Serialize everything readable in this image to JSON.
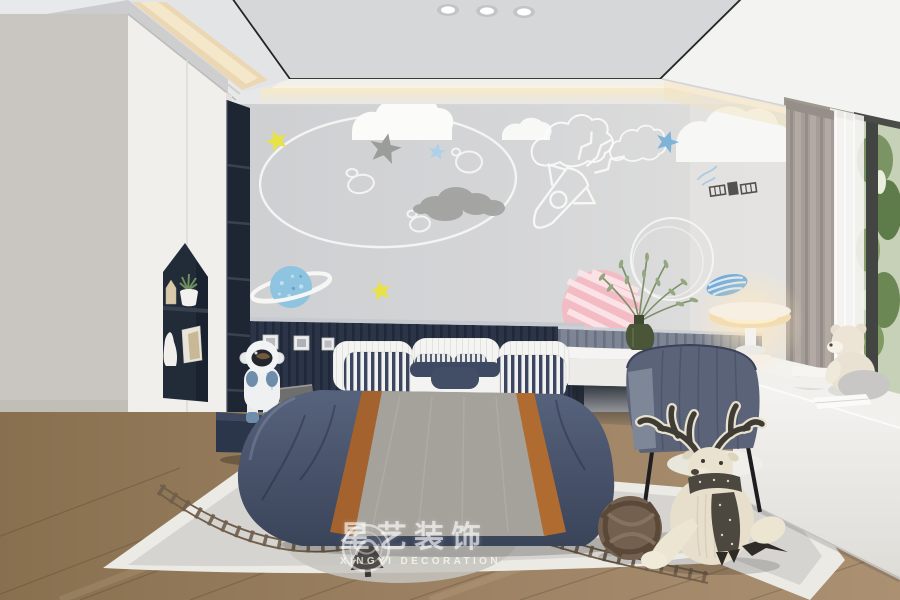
{
  "meta": {
    "type": "interior-design-3d-render",
    "room": "children-bedroom-space-theme",
    "canvas": {
      "width": 900,
      "height": 600
    }
  },
  "watermark": {
    "logo": "xingyi-circle-seal",
    "cn": "星艺装饰",
    "en": "XINGYI DECORATION"
  },
  "palette": {
    "wall": "#d2d3d5",
    "ceiling_panel": "#d5d7d9",
    "trim_black": "#242424",
    "cove_glow": "#f2e2bd",
    "wardrobe_white": "#f0efec",
    "accent_navy": "#2c3547",
    "shelf_navy": "#1e2634",
    "duvet_navy": "#46526b",
    "duvet_gray": "#a5a29b",
    "stripe_caramel": "#a8652c",
    "bed_base_gray": "#8f8d88",
    "wood_floor": "#9a8064",
    "rug_field": "#d6d4d0",
    "rug_border": "#eceae5",
    "track_brown": "#6f5e4b",
    "curtain_gray": "#a59d97",
    "sheer_white": "#f6f5f2",
    "window_green": "#7a9463",
    "seat_white": "#f1f0ed",
    "chair_navy": "#5a6377",
    "lamp_warm": "#f3ddb0",
    "deer_cream": "#e7dfcb",
    "deer_dark": "#4c4840",
    "knot_brown": "#74604f",
    "astronaut_white": "#eef0f1",
    "astronaut_blue": "#6d8dab",
    "star_yellow": "#e9e244",
    "star_blue": "#7fb3d8",
    "star_gray": "#9c9c9a",
    "planet_blue": "#8ec4e0",
    "planet_pink": "#f3bcc4",
    "plant_green": "#7d8f6a"
  },
  "scene": {
    "ceiling": {
      "downlight_count": 3,
      "cove_lighting": true
    },
    "wall_art": [
      "moon-outline",
      "craters",
      "solid-clouds",
      "outline-clouds",
      "gray-cloud",
      "yellow-stars",
      "gray-star",
      "blue-stars",
      "rocket-sketch",
      "satellite-sketch",
      "saturn-planet",
      "striped-blue-planet",
      "pink-striped-planet",
      "outline-planet"
    ],
    "furniture": [
      "wardrobe-with-house-niche",
      "navy-open-shelf",
      "slatted-headboard-wall",
      "bed",
      "floating-nightstand",
      "desk",
      "desk-chair",
      "window-seat",
      "table-lamp",
      "curtains",
      "window"
    ],
    "decor": [
      "astronaut-figurine",
      "plant-pot",
      "wooden-house-ornament",
      "cat-figurine",
      "books",
      "olive-branch-vase",
      "teddy-bear",
      "bolster-pillows",
      "knot-ball-pillow",
      "deer-plush",
      "train-track-rug",
      "pine-tree-motif"
    ],
    "counts": {
      "headboard_frames": 3,
      "back_pillows": 3,
      "striped_pillows": 4
    }
  }
}
